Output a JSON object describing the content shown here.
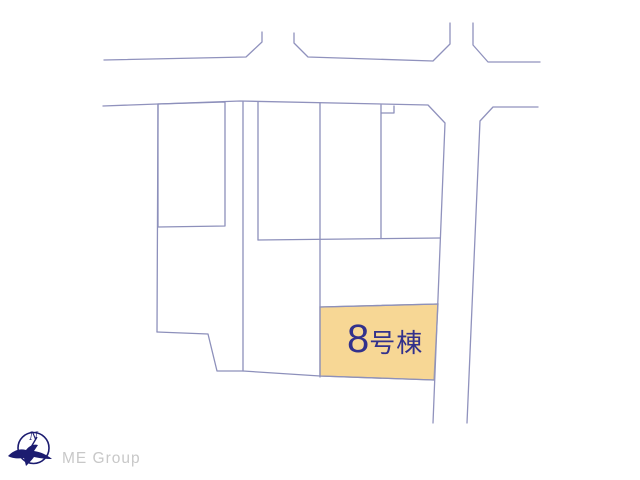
{
  "page": {
    "width": 640,
    "height": 480,
    "background": "#ffffff"
  },
  "colors": {
    "boundary_line": "#8d90bb",
    "road_line": "#9092bd",
    "highlight_fill": "#f7d795",
    "highlight_stroke": "#a7a4a0",
    "label_color": "#32318c",
    "compass_navy": "#1c1c70",
    "logo_gray": "#c8c8c8"
  },
  "map": {
    "roads": [
      {
        "name": "road-edge-top-west",
        "points": "104,60 246,57 262,42 262,32"
      },
      {
        "name": "road-edge-top-middle",
        "points": "294,33 294,43 308,57 433,61 450,44 450,23"
      },
      {
        "name": "road-edge-top-east",
        "points": "473,23 473,45 488,62 540,62"
      },
      {
        "name": "road-edge-parceltop-southroad-west",
        "points": "103,106 240,101 428,105 445,123 433,423"
      },
      {
        "name": "road-edge-east-southroad-east",
        "points": "538,107 493,107 480,121 467,423"
      }
    ],
    "parcel_lines": [
      {
        "name": "parcel-rectangle-west",
        "points": "158,104 225,102 225,226 158,227 158,104"
      },
      {
        "name": "boundary-west-vertical",
        "points": "158,104 157,332"
      },
      {
        "name": "boundary-bottom",
        "points": "157,332 208,334 217,371 243,371 320,376 434,380"
      },
      {
        "name": "boundary-vertical-1",
        "points": "243,102 243,371"
      },
      {
        "name": "boundary-vertical-2",
        "points": "258,102 258,240"
      },
      {
        "name": "boundary-vertical-3",
        "points": "320,103 320,377"
      },
      {
        "name": "boundary-vertical-4",
        "points": "381,105 381,238"
      },
      {
        "name": "boundary-notch",
        "points": "381,113 394,113 394,106"
      },
      {
        "name": "boundary-horizontal-mid",
        "points": "258,240 440,238"
      },
      {
        "name": "highlight-top-edge",
        "points": "320,307 438,304"
      }
    ],
    "highlight_parcel": {
      "name": "lot-8",
      "points": "320,307 438,304 434,380 320,376",
      "label_number": "8",
      "label_suffix": "号棟"
    }
  },
  "compass": {
    "letter": "N"
  },
  "logo": {
    "text": "ME Group"
  }
}
